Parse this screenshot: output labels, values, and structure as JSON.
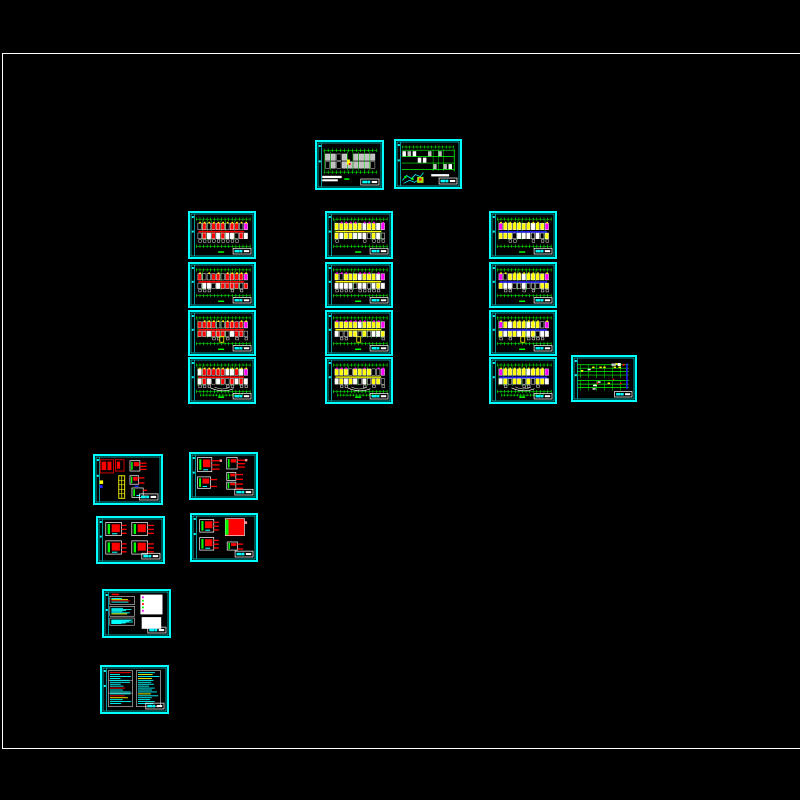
{
  "window": {
    "background": "#000000"
  },
  "paper_frame": {
    "x": 2,
    "y": 53,
    "width": 845,
    "height": 694,
    "stroke": "#ffffff"
  },
  "palette": {
    "cyan": "#00ffff",
    "green": "#00ff00",
    "red": "#ff0000",
    "yellow": "#ffff00",
    "magenta": "#ff00ff",
    "blue": "#2222ff",
    "white": "#ffffff",
    "gray": "#c0c0c0",
    "pink": "#ff9a9a",
    "lime": "#aadd00"
  },
  "sheets": [
    {
      "name": "site-plan-sheet",
      "kind": "site-plan",
      "x": 315,
      "y": 140,
      "w": 69,
      "h": 50
    },
    {
      "name": "roof-plan-sheet",
      "kind": "elev-plan",
      "x": 394,
      "y": 139,
      "w": 68,
      "h": 50
    },
    {
      "name": "lighting-plan-floor-1",
      "kind": "plan-red",
      "x": 188,
      "y": 211,
      "w": 68,
      "h": 48
    },
    {
      "name": "lighting-plan-floor-2",
      "kind": "plan-red",
      "x": 188,
      "y": 262,
      "w": 68,
      "h": 46
    },
    {
      "name": "lighting-plan-floor-3",
      "kind": "plan-red",
      "x": 188,
      "y": 310,
      "w": 68,
      "h": 46,
      "variant": "stub"
    },
    {
      "name": "lighting-plan-floor-4",
      "kind": "plan-red",
      "x": 188,
      "y": 357,
      "w": 68,
      "h": 47,
      "variant": "arcs"
    },
    {
      "name": "power-plan-floor-1",
      "kind": "plan-yellow",
      "x": 325,
      "y": 211,
      "w": 68,
      "h": 48
    },
    {
      "name": "power-plan-floor-2",
      "kind": "plan-yellow",
      "x": 325,
      "y": 262,
      "w": 68,
      "h": 46
    },
    {
      "name": "power-plan-floor-3",
      "kind": "plan-yellow",
      "x": 325,
      "y": 310,
      "w": 68,
      "h": 46,
      "variant": "stub"
    },
    {
      "name": "power-plan-floor-4",
      "kind": "plan-yellow",
      "x": 325,
      "y": 357,
      "w": 68,
      "h": 47,
      "variant": "arcs"
    },
    {
      "name": "weak-current-plan-floor-1",
      "kind": "plan-blue",
      "x": 489,
      "y": 211,
      "w": 68,
      "h": 48
    },
    {
      "name": "weak-current-plan-floor-2",
      "kind": "plan-blue",
      "x": 489,
      "y": 262,
      "w": 68,
      "h": 46
    },
    {
      "name": "weak-current-plan-floor-3",
      "kind": "plan-blue",
      "x": 489,
      "y": 310,
      "w": 68,
      "h": 46,
      "variant": "stub"
    },
    {
      "name": "weak-current-plan-floor-4",
      "kind": "plan-blue",
      "x": 489,
      "y": 357,
      "w": 68,
      "h": 47,
      "variant": "arcs"
    },
    {
      "name": "riser-diagram-sheet",
      "kind": "riser",
      "x": 571,
      "y": 355,
      "w": 66,
      "h": 47
    },
    {
      "name": "distribution-detail-sheet-1",
      "kind": "detail-a",
      "x": 93,
      "y": 454,
      "w": 70,
      "h": 51
    },
    {
      "name": "distribution-detail-sheet-2",
      "kind": "detail-b",
      "x": 189,
      "y": 452,
      "w": 69,
      "h": 48
    },
    {
      "name": "distribution-detail-sheet-3",
      "kind": "detail-c",
      "x": 96,
      "y": 516,
      "w": 69,
      "h": 48
    },
    {
      "name": "distribution-detail-sheet-4",
      "kind": "detail-d",
      "x": 190,
      "y": 513,
      "w": 68,
      "h": 49
    },
    {
      "name": "legend-notes-sheet",
      "kind": "notes-legend",
      "x": 102,
      "y": 589,
      "w": 69,
      "h": 49
    },
    {
      "name": "design-notes-sheet",
      "kind": "notes-text",
      "x": 100,
      "y": 665,
      "w": 69,
      "h": 49
    }
  ]
}
